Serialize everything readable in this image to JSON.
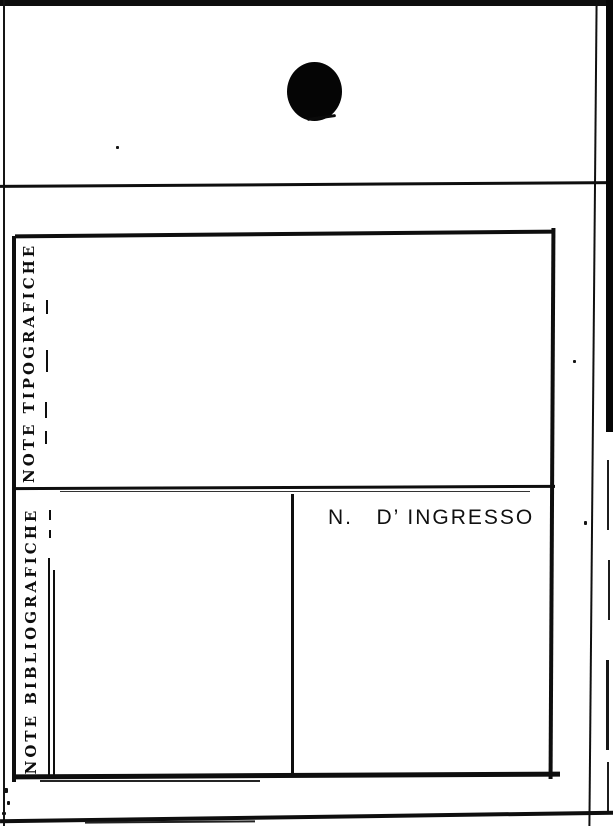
{
  "page": {
    "background": "#ffffff",
    "ink": "#0e0e0e"
  },
  "card": {
    "sections": [
      {
        "title": "NOTE TIPOGRAFICHE",
        "fields": [
          {
            "label": "L. di pubbl.",
            "dots": " . .  .  .  . . . . . . . .  . ."
          },
          {
            "label": "Editore",
            "dots": "       .  . .  . , . . .  . . . . . . . . . . ."
          },
          {
            "label": "L. di stampa",
            "dots": " .             .  . . ."
          },
          {
            "label": "Tipografia",
            "dots": "  .             .  .  . -"
          },
          {
            "label": "Data",
            "dots": "      .           ."
          }
        ]
      },
      {
        "title": "NOTE BIBLIOGRAFICHE",
        "fields": [
          {
            "label": "Edizione",
            "dots": "...................."
          },
          {
            "label": "Formato",
            "dots": " ..................-"
          },
          {
            "label": "Volume",
            "dots": " . . . . . ..........."
          },
          {
            "label": "Pagine",
            "dots": " .....,.............."
          },
          {
            "label": "Tavole",
            "dots": " ..................-"
          },
          {
            "label": "Legatura",
            "dots": ".................-"
          }
        ]
      }
    ],
    "ingresso": {
      "label": "N.   D’ INGRESSO"
    }
  }
}
